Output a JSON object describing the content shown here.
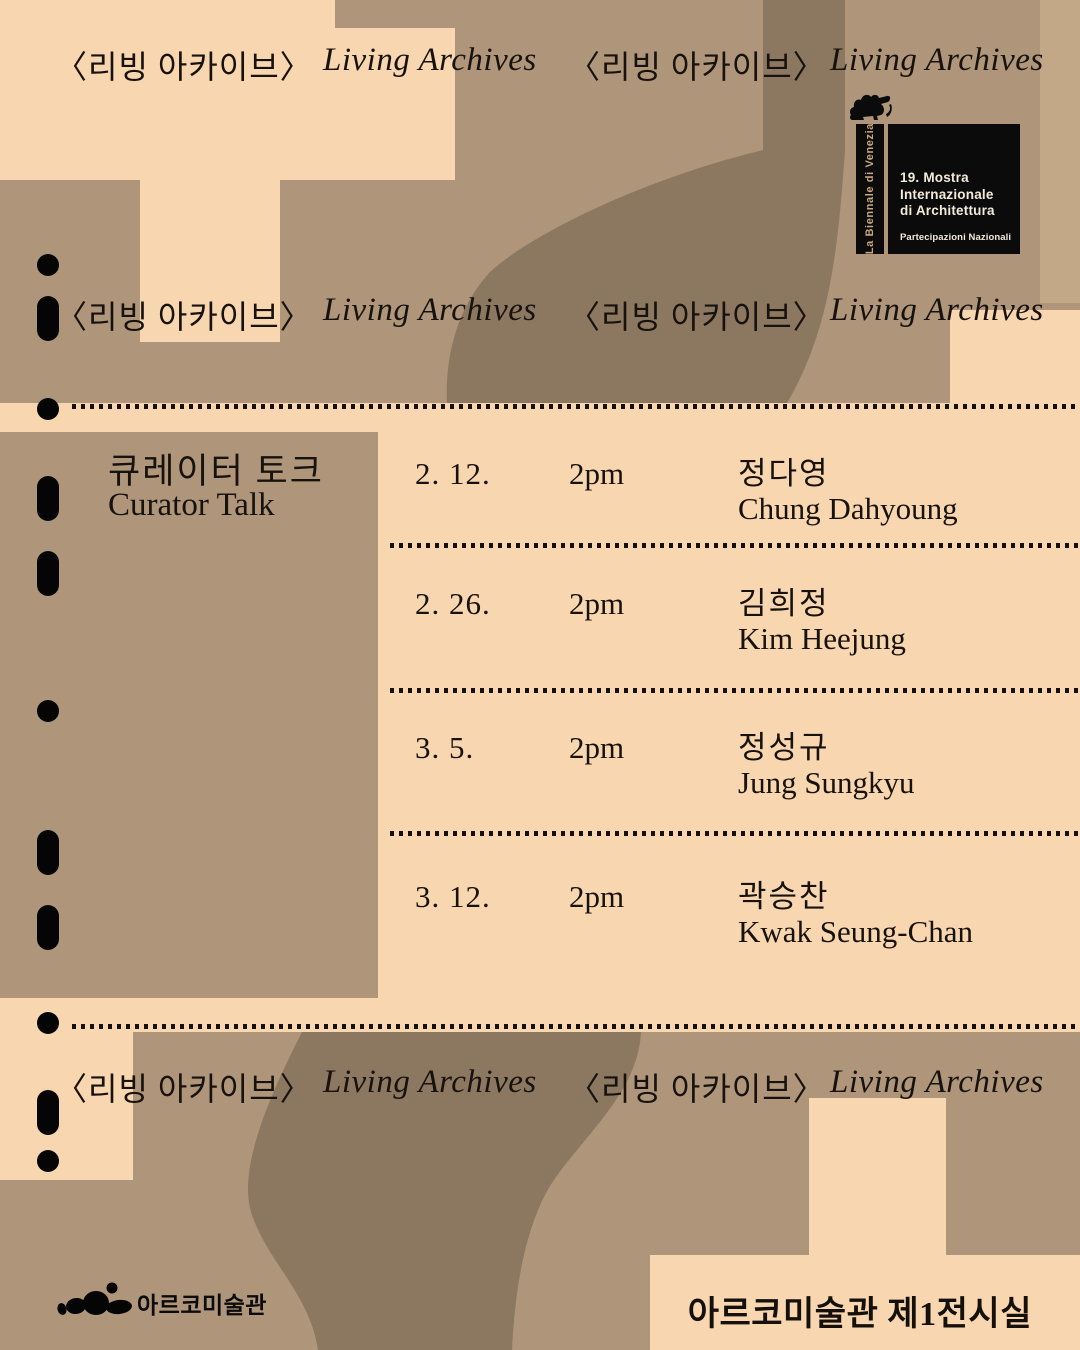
{
  "poster": {
    "marquee": [
      {
        "lang": "ko",
        "text": "〈리빙 아카이브〉"
      },
      {
        "lang": "en",
        "text": "Living Archives"
      },
      {
        "lang": "ko",
        "text": "〈리빙 아카이브〉"
      },
      {
        "lang": "en",
        "text": "Living Archives"
      }
    ],
    "biennale": {
      "vertical_label": "La Biennale di Venezia",
      "title_line1": "19. Mostra",
      "title_line2": "Internazionale",
      "title_line3": "di Architettura",
      "subtitle": "Partecipazioni Nazionali"
    },
    "program": {
      "title_ko": "큐레이터 토크",
      "title_en": "Curator Talk",
      "sessions": [
        {
          "date": "2. 12.",
          "time": "2pm",
          "name_ko": "정다영",
          "name_en": "Chung Dahyoung"
        },
        {
          "date": "2. 26.",
          "time": "2pm",
          "name_ko": "김희정",
          "name_en": "Kim Heejung"
        },
        {
          "date": "3. 5.",
          "time": "2pm",
          "name_ko": "정성규",
          "name_en": "Jung Sungkyu"
        },
        {
          "date": "3. 12.",
          "time": "2pm",
          "name_ko": "곽승찬",
          "name_en": "Kwak Seung-Chan"
        }
      ]
    },
    "footer": {
      "logo_text": "아르코미술관",
      "venue": "아르코미술관 제1전시실"
    },
    "colors": {
      "cream": "#F8D6B0",
      "tan": "#AF967B",
      "tan_light": "#C2A887",
      "taupe": "#8C7860",
      "ink": "#17120D",
      "biennale_gold": "#C9A87C",
      "biennale_panel": "#0B0B0B",
      "panel_text": "#F3EADA"
    }
  }
}
